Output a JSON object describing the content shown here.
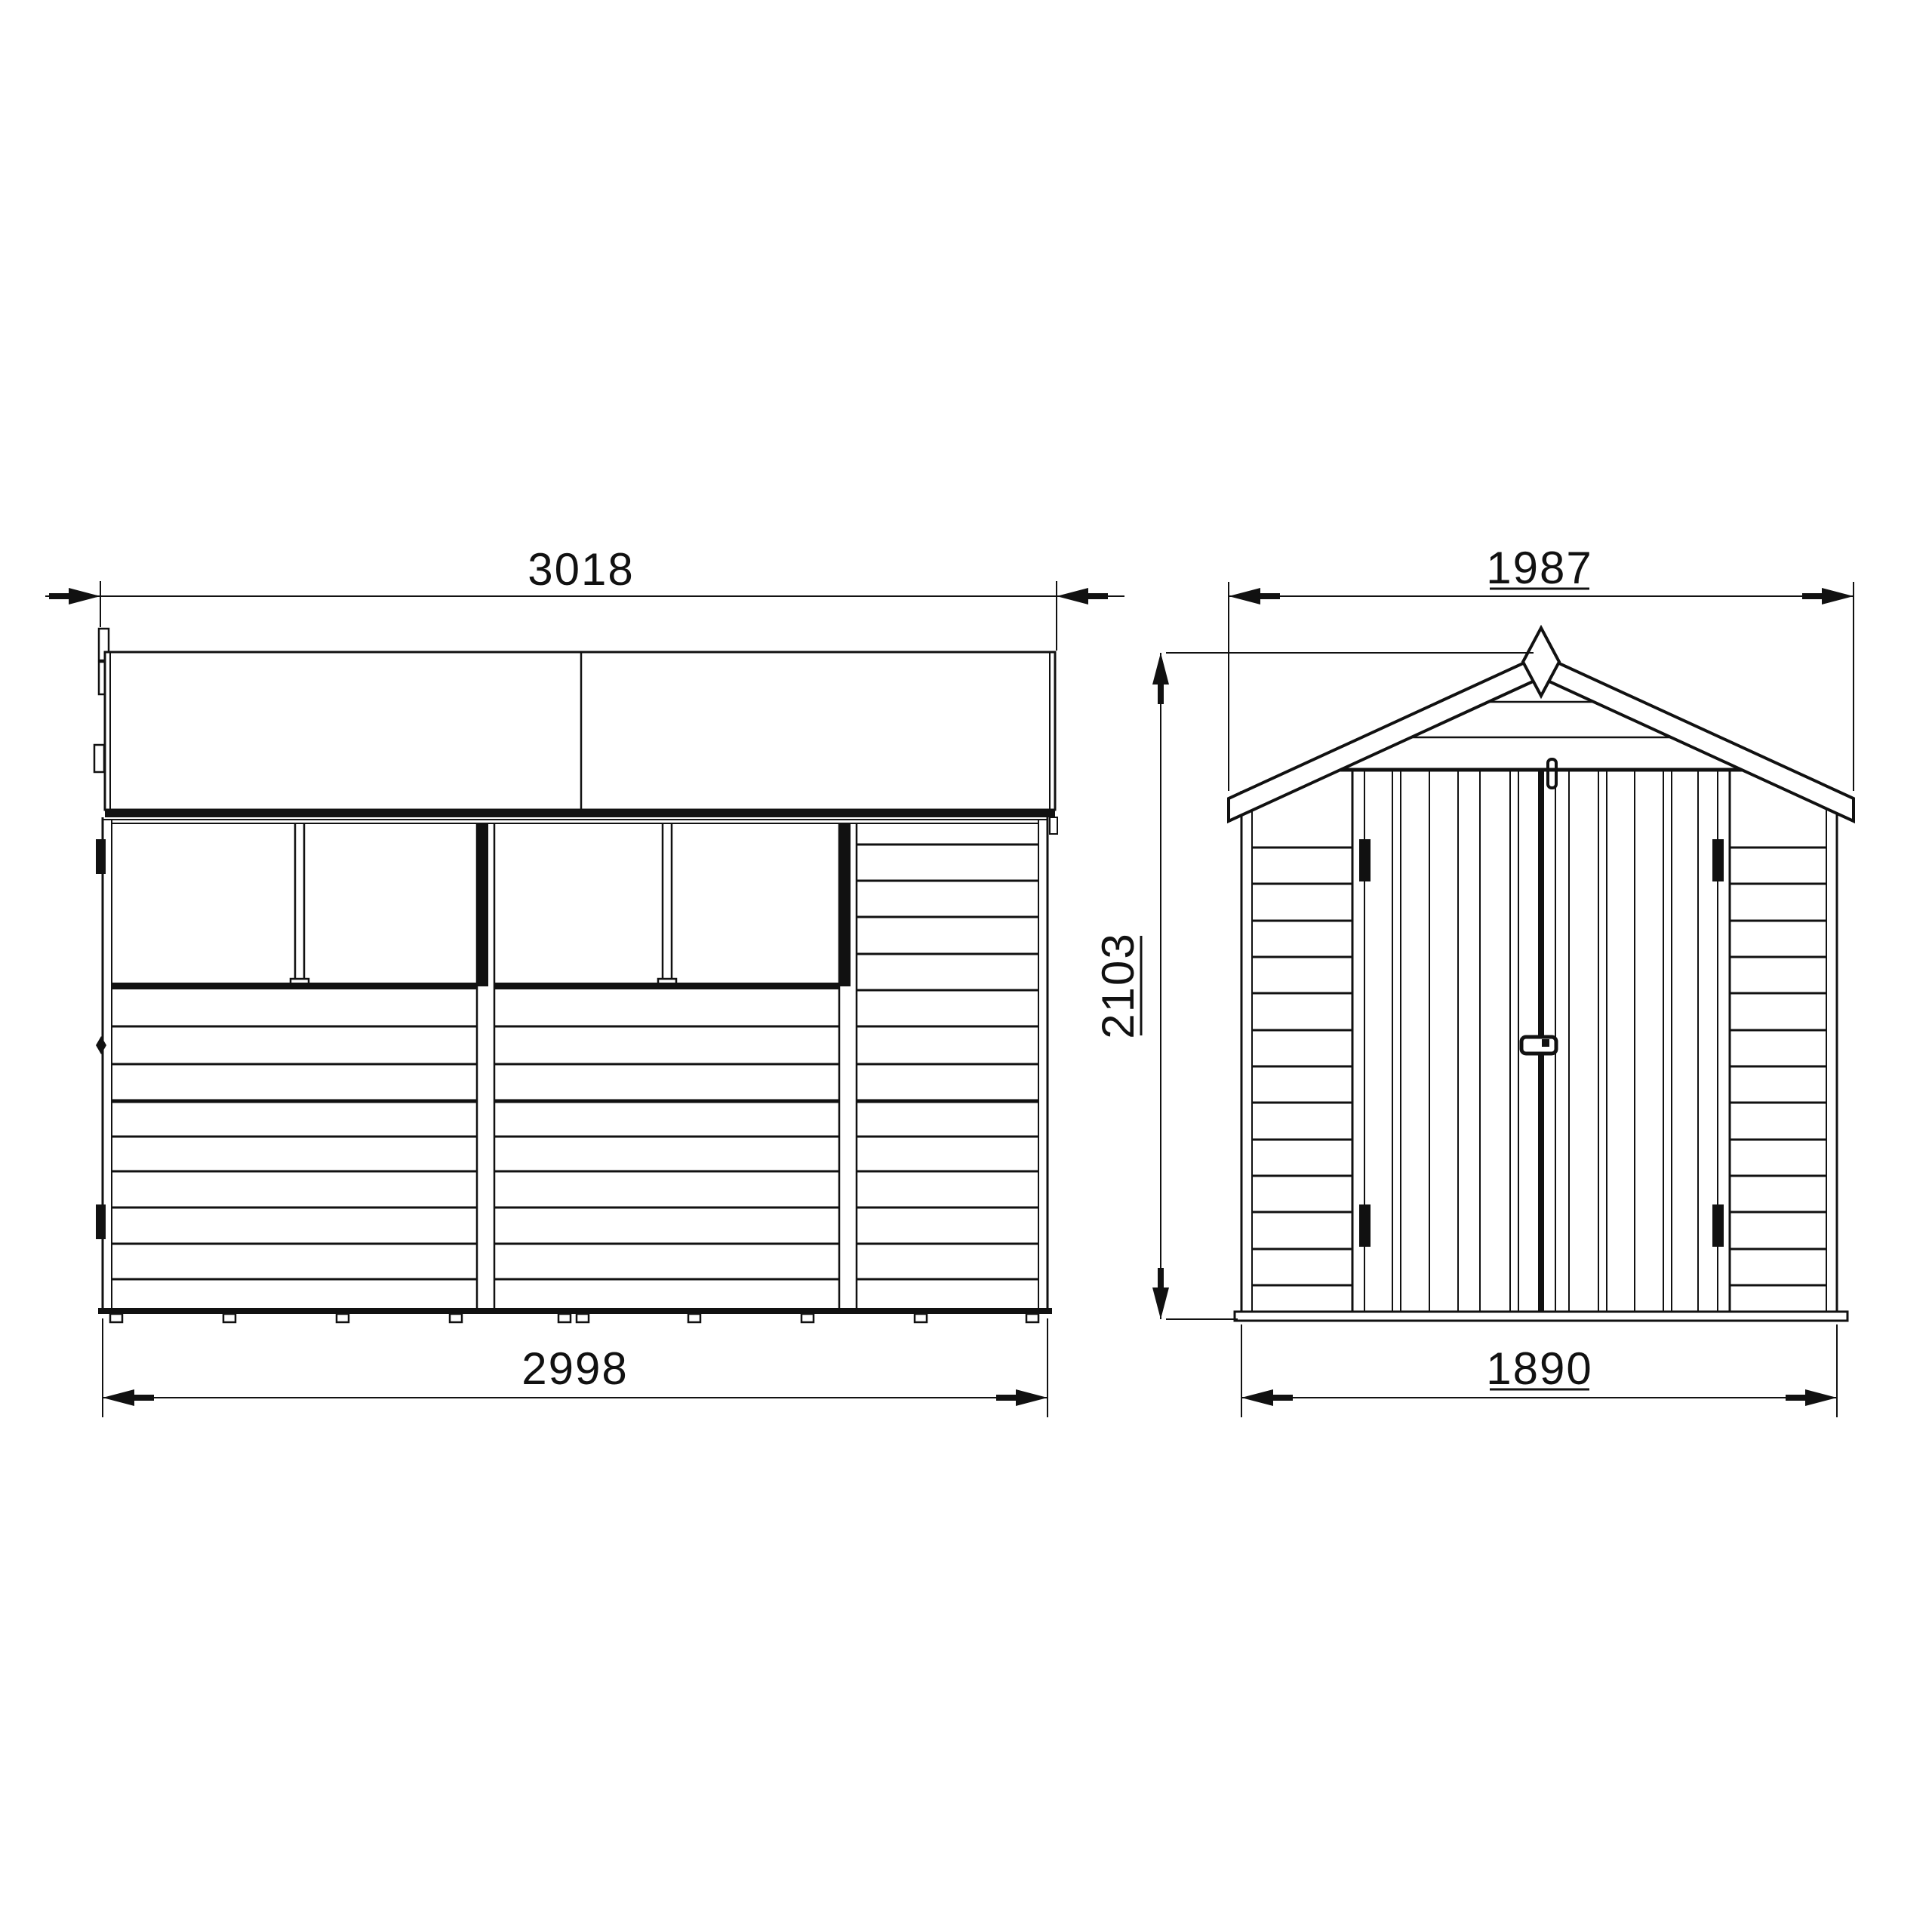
{
  "page": {
    "background": "#ffffff",
    "line_color": "#111111"
  },
  "drawing": {
    "type": "technical-elevation-drawing",
    "subject": "apex garden shed with double doors - dimensioned elevations",
    "views": [
      {
        "name": "side elevation",
        "dim_roof_width": "3018",
        "dim_base_width": "2998"
      },
      {
        "name": "front elevation",
        "dim_roof_width": "1987",
        "dim_base_width": "1890",
        "dim_ridge_height": "2103"
      }
    ]
  }
}
